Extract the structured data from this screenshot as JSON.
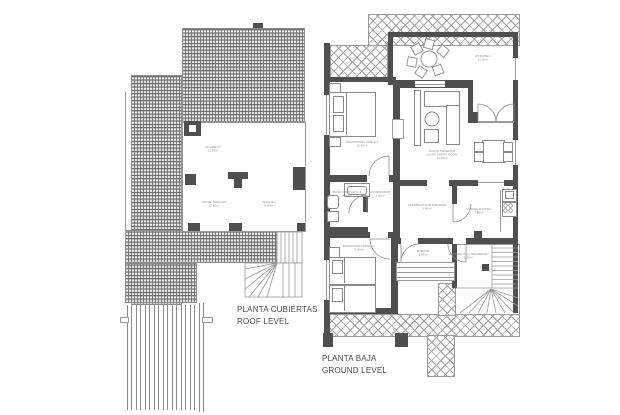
{
  "canvas": {
    "width": 620,
    "height": 415,
    "background": "#ffffff"
  },
  "colors": {
    "wall_fill": "#4f4f4f",
    "hatch_line": "#9a9a9a",
    "tile_line": "#6e6e6e",
    "title_text": "#4a4a4a",
    "label_text": "#8f8f8f"
  },
  "roof_plan": {
    "title": "PLANTA CUBIERTAS\nROOF LEVEL",
    "labels": {
      "solarium": "SOLARIUM\n21.50m²",
      "torre_terraza": "TORRE TERRAZA\n12.80m²",
      "pergola": "PÉRGOLA\n8.40m²"
    }
  },
  "ground_plan": {
    "title": "PLANTA BAJA\nGROUND LEVEL",
    "rooms": {
      "porch": "PORCHE 1\n13.60m²",
      "bedroom1": "DORMITORIO DOBLE 1\n12.40m²",
      "living": "SALÓN COMEDOR\nLIVING DINING ROOM\n24.60m²",
      "bathroom": "BAÑO COMPLETO 1\n4.20m²",
      "hall": "DISTRIBUIDOR\n2.60m²",
      "vestibule": "VESTÍBULO DISTRIBUIDOR\n5.40m²",
      "kitchen": "COCINA KITCHEN\n7.80m²",
      "bedroom2": "DORMITORIO DOBLE 2\n11.90m²",
      "porch2": "PORCHE\n3.40m²",
      "entrance": "ENTRADA HALL RECIBIDOR\n4.30m²"
    }
  }
}
